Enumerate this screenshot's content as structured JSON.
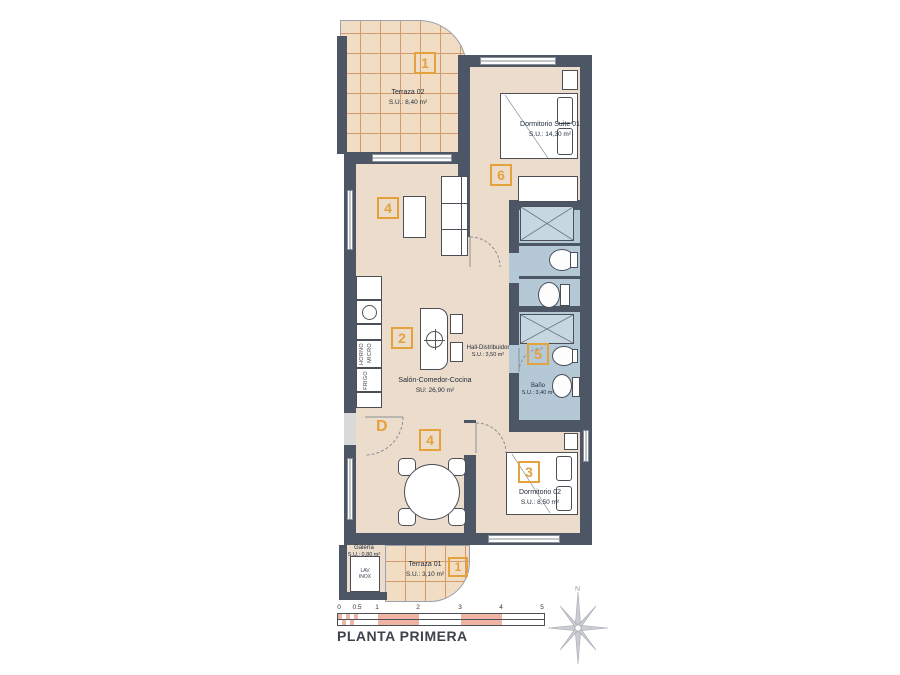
{
  "title": "PLANTA PRIMERA",
  "compass": {
    "north": "N"
  },
  "rooms": [
    {
      "name": "Terraza 02",
      "area": "S.U.: 8,40 m²",
      "marker": "1"
    },
    {
      "name": "Dormitorio Suite 01",
      "area": "S.U.: 14,30 m²",
      "marker": "6"
    },
    {
      "name": "Salón-Comedor-Cocina",
      "area": "SU: 26,90 m²",
      "markers": [
        "4",
        "2",
        "4"
      ]
    },
    {
      "name": "Hall-Distribuidor",
      "area": "S.U.: 3,50 m²"
    },
    {
      "name": "Baño",
      "area": "S.U.: 3,40 m²",
      "marker": "5"
    },
    {
      "name": "Dormitorio 02",
      "area": "S.U.: 8,50 m²",
      "marker": "3"
    },
    {
      "name": "Galería",
      "area": "S.U.: 0,80 m²"
    },
    {
      "name": "Terraza 01",
      "area": "S.U.: 3,10 m²",
      "marker": "1"
    }
  ],
  "labels": {
    "door_letter": "D",
    "appliances": {
      "horno": "HORNO",
      "micro": "MICRO",
      "frigo": "FRIGO",
      "lav1": "LAV",
      "lav2": "INOX"
    }
  },
  "scale_bar": {
    "ticks": [
      "0",
      "0.5",
      "1",
      "2",
      "3",
      "4",
      "5"
    ]
  },
  "colors": {
    "wall": "#4d5665",
    "floor": "#ecdccb",
    "terrace": "#f0ddc3",
    "terrace_grid": "#d49a6e",
    "bath_floor": "#b5c8d6",
    "marker_accent": "#e5a13c",
    "scale_fill": "#f0b4a4"
  }
}
